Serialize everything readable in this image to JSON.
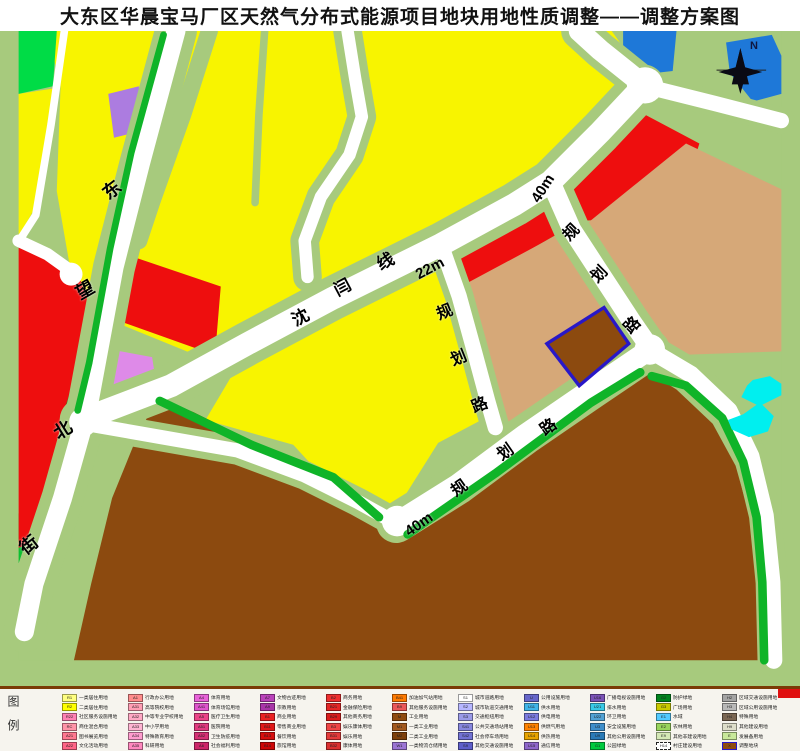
{
  "title": "大东区华晨宝马厂区天然气分布式能源项目地块用地性质调整——调整方案图",
  "map": {
    "north_label": "N",
    "palette": {
      "background_sage": "#A7CA7D",
      "residential_yellow": "#F8F400",
      "park_green": "#00DC46",
      "strip_green": "#0FB428",
      "commercial_red": "#EE0E0E",
      "logistics_tan": "#D6A878",
      "industrial_brown": "#8C4A0F",
      "culture_purple": "#AC7CE0",
      "medical_violet": "#DE8AE8",
      "admin_blue": "#1E78D8",
      "water_cyan": "#00EFEF",
      "road_white": "#FFFFFF",
      "highlight_outline_blue": "#2817C8"
    },
    "labels": [
      {
        "text": "东",
        "x": 103,
        "y": 150,
        "rot": -38,
        "size": 18
      },
      {
        "text": "望",
        "x": 76,
        "y": 250,
        "rot": -30,
        "size": 18
      },
      {
        "text": "北",
        "x": 54,
        "y": 390,
        "rot": -32,
        "size": 18
      },
      {
        "text": "街",
        "x": 20,
        "y": 505,
        "rot": -38,
        "size": 18
      },
      {
        "text": "沈",
        "x": 292,
        "y": 278,
        "rot": -28,
        "size": 17
      },
      {
        "text": "闫",
        "x": 334,
        "y": 248,
        "rot": -28,
        "size": 17
      },
      {
        "text": "线",
        "x": 377,
        "y": 222,
        "rot": -28,
        "size": 17
      },
      {
        "text": "22m",
        "x": 415,
        "y": 230,
        "rot": -28,
        "size": 15
      },
      {
        "text": "40m",
        "x": 528,
        "y": 150,
        "rot": -58,
        "size": 15
      },
      {
        "text": "规",
        "x": 437,
        "y": 274,
        "rot": -22,
        "size": 16
      },
      {
        "text": "划",
        "x": 451,
        "y": 320,
        "rot": -22,
        "size": 16
      },
      {
        "text": "路",
        "x": 472,
        "y": 367,
        "rot": -22,
        "size": 16
      },
      {
        "text": "规",
        "x": 564,
        "y": 194,
        "rot": -45,
        "size": 16
      },
      {
        "text": "划",
        "x": 592,
        "y": 236,
        "rot": -45,
        "size": 16
      },
      {
        "text": "路",
        "x": 625,
        "y": 287,
        "rot": -45,
        "size": 16
      },
      {
        "text": "40m",
        "x": 404,
        "y": 486,
        "rot": -35,
        "size": 15
      },
      {
        "text": "规",
        "x": 452,
        "y": 450,
        "rot": -35,
        "size": 16
      },
      {
        "text": "划",
        "x": 498,
        "y": 414,
        "rot": -35,
        "size": 16
      },
      {
        "text": "路",
        "x": 541,
        "y": 389,
        "rot": -35,
        "size": 16
      }
    ]
  },
  "legend": {
    "side_label": "图例",
    "entries": [
      {
        "code": "R1",
        "label": "一类居住用地",
        "color": "#FFFF80"
      },
      {
        "code": "R2",
        "label": "二类居住用地",
        "color": "#FFFF00"
      },
      {
        "code": "R22",
        "label": "社区服务设施用地",
        "color": "#FF80B4"
      },
      {
        "code": "RC",
        "label": "商住混合用地",
        "color": "#FF94A8"
      },
      {
        "code": "A21",
        "label": "图书展览用地",
        "color": "#FF7890"
      },
      {
        "code": "A22",
        "label": "文化活动用地",
        "color": "#FF6486"
      },
      {
        "code": "A1",
        "label": "行政办公用地",
        "color": "#FF8C8C"
      },
      {
        "code": "A31",
        "label": "高等院校用地",
        "color": "#FF9EB4"
      },
      {
        "code": "A32",
        "label": "中等专业学校用地",
        "color": "#FFA8C4"
      },
      {
        "code": "A33",
        "label": "中小学用地",
        "color": "#FFB4D2"
      },
      {
        "code": "A34",
        "label": "特殊教育用地",
        "color": "#FF9CCE"
      },
      {
        "code": "A35",
        "label": "科研用地",
        "color": "#FF88BE"
      },
      {
        "code": "A4",
        "label": "体育用地",
        "color": "#E862D8"
      },
      {
        "code": "A41",
        "label": "体育场馆用地",
        "color": "#DE55CC"
      },
      {
        "code": "A5",
        "label": "医疗卫生用地",
        "color": "#EA4488"
      },
      {
        "code": "A51",
        "label": "医院用地",
        "color": "#E03A7E"
      },
      {
        "code": "A52",
        "label": "卫生防疫用地",
        "color": "#D63074"
      },
      {
        "code": "A6",
        "label": "社会福利用地",
        "color": "#CC2668"
      },
      {
        "code": "A7",
        "label": "文物古迹用地",
        "color": "#BA42BA"
      },
      {
        "code": "A9",
        "label": "宗教用地",
        "color": "#A836A8"
      },
      {
        "code": "B1",
        "label": "商业用地",
        "color": "#EA2222"
      },
      {
        "code": "B11",
        "label": "零售商业用地",
        "color": "#E01818"
      },
      {
        "code": "B13",
        "label": "餐饮用地",
        "color": "#D60E0E"
      },
      {
        "code": "B14",
        "label": "旅馆用地",
        "color": "#CC0606"
      },
      {
        "code": "B2",
        "label": "商务用地",
        "color": "#EE3030"
      },
      {
        "code": "B21",
        "label": "金融保险用地",
        "color": "#E42626"
      },
      {
        "code": "B29",
        "label": "其他商务用地",
        "color": "#DA1C1C"
      },
      {
        "code": "B3",
        "label": "娱乐康体用地",
        "color": "#EE4444"
      },
      {
        "code": "B31",
        "label": "娱乐用地",
        "color": "#E43A3A"
      },
      {
        "code": "B32",
        "label": "康体用地",
        "color": "#DA3030"
      },
      {
        "code": "B41",
        "label": "加油加气站用地",
        "color": "#FF7A00"
      },
      {
        "code": "B9",
        "label": "其他服务设施用地",
        "color": "#EA5858"
      },
      {
        "code": "M",
        "label": "工业用地",
        "color": "#8F4B10"
      },
      {
        "code": "M1",
        "label": "一类工业用地",
        "color": "#A2591E"
      },
      {
        "code": "M2",
        "label": "二类工业用地",
        "color": "#7E400B"
      },
      {
        "code": "W1",
        "label": "一类物流仓储用地",
        "color": "#9B74D4"
      },
      {
        "code": "S1",
        "label": "城市道路用地",
        "color": "#FFFFFF"
      },
      {
        "code": "S2",
        "label": "城市轨道交通用地",
        "color": "#B6B6FF"
      },
      {
        "code": "S3",
        "label": "交通枢纽用地",
        "color": "#9A9AE8"
      },
      {
        "code": "S41",
        "label": "公共交通场站用地",
        "color": "#8686DE"
      },
      {
        "code": "S42",
        "label": "社会停车场用地",
        "color": "#7272D4"
      },
      {
        "code": "S9",
        "label": "其他交通设施用地",
        "color": "#5E5ECA"
      },
      {
        "code": "U",
        "label": "公用设施用地",
        "color": "#6666CA"
      },
      {
        "code": "U11",
        "label": "供水用地",
        "color": "#40B4E8"
      },
      {
        "code": "U12",
        "label": "供电用地",
        "color": "#7A7ADE"
      },
      {
        "code": "U13",
        "label": "供燃气用地",
        "color": "#FF8200"
      },
      {
        "code": "U14",
        "label": "供热用地",
        "color": "#E8A400"
      },
      {
        "code": "U15",
        "label": "通信用地",
        "color": "#8E66CA"
      },
      {
        "code": "U16",
        "label": "广播电视设施用地",
        "color": "#7A52B6"
      },
      {
        "code": "U21",
        "label": "排水用地",
        "color": "#38C8E6"
      },
      {
        "code": "U22",
        "label": "环卫用地",
        "color": "#52A2D4"
      },
      {
        "code": "U3",
        "label": "安全设施用地",
        "color": "#3E8ECA"
      },
      {
        "code": "U9",
        "label": "其他公用设施用地",
        "color": "#2A7AB6"
      },
      {
        "code": "G1",
        "label": "公园绿地",
        "color": "#00CA3E"
      },
      {
        "code": "G2",
        "label": "防护绿地",
        "color": "#00841E"
      },
      {
        "code": "G3",
        "label": "广场用地",
        "color": "#CACA00"
      },
      {
        "code": "E1",
        "label": "水域",
        "color": "#52CAFF"
      },
      {
        "code": "E2",
        "label": "农林用地",
        "color": "#98D45C"
      },
      {
        "code": "E9",
        "label": "其他非建设用地",
        "color": "#D4E8B6"
      },
      {
        "code": "H14",
        "label": "村庄建设用地",
        "color": "#FFFFFF",
        "dashed": true
      },
      {
        "code": "H2",
        "label": "区域交通设施用地",
        "color": "#A4A4A4"
      },
      {
        "code": "H3",
        "label": "区域公用设施用地",
        "color": "#B8B8B8"
      },
      {
        "code": "H4",
        "label": "特殊用地",
        "color": "#7A6652"
      },
      {
        "code": "H9",
        "label": "其他建设用地",
        "color": "#DEDECA"
      },
      {
        "code": "E",
        "label": "发展备用地",
        "color": "#C8E89A"
      },
      {
        "code": "X",
        "label": "调整地块",
        "color": "#8F4B10",
        "outline": "#2817C8"
      }
    ]
  }
}
